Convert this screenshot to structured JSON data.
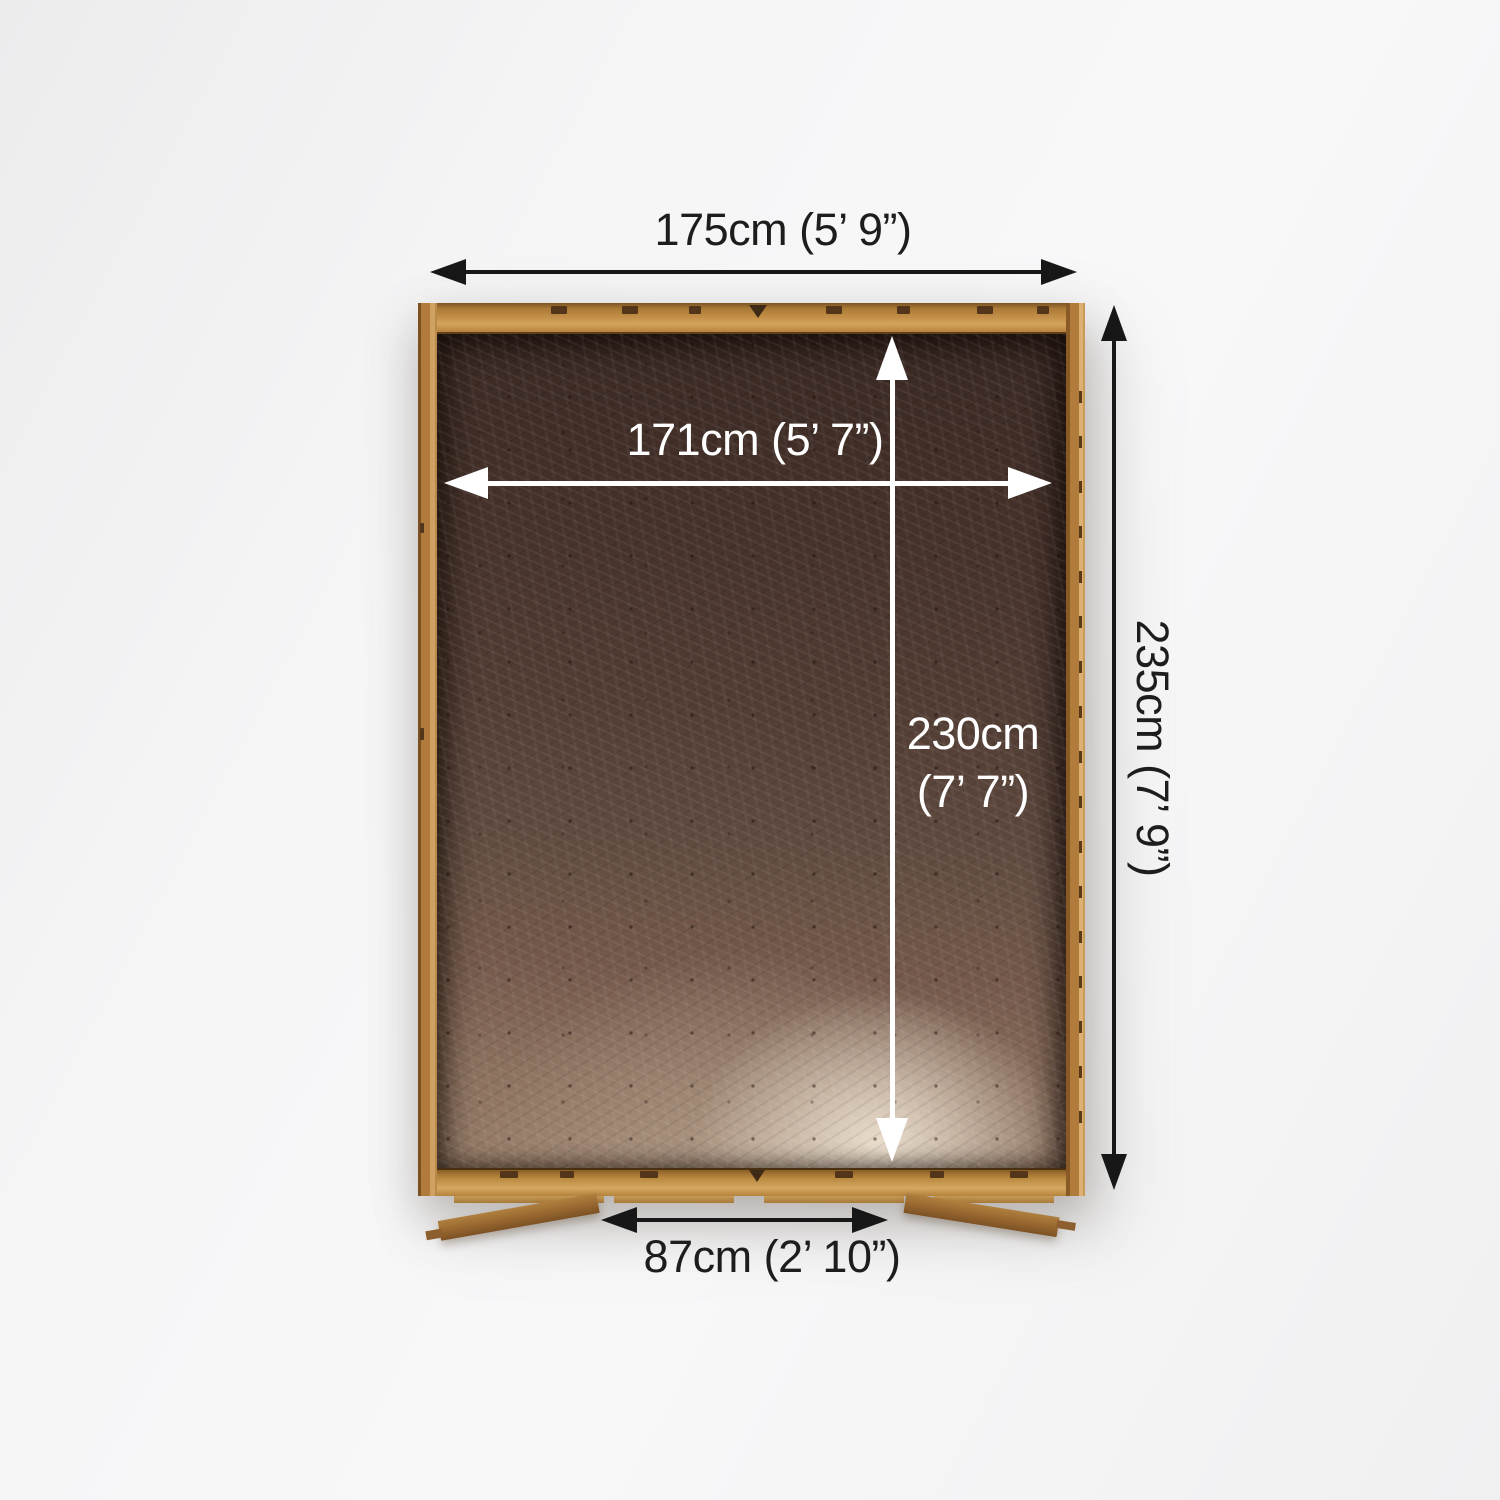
{
  "diagram": {
    "subject": "shed base top view with dimensions",
    "labels": {
      "outer_width": "175cm (5’ 9”)",
      "inner_width": "171cm (5’ 7”)",
      "outer_depth": "235cm (7’ 9”)",
      "inner_depth_line1": "230cm",
      "inner_depth_line2": "(7’ 7”)",
      "door_width": "87cm (2’ 10”)"
    },
    "colors": {
      "dimension_dark": "#171717",
      "dimension_light": "#ffffff",
      "frame_wood": "#b5823f",
      "floor_dark": "#3a2822",
      "floor_light": "#cdbaa3",
      "background": "#f3f3f4"
    }
  }
}
